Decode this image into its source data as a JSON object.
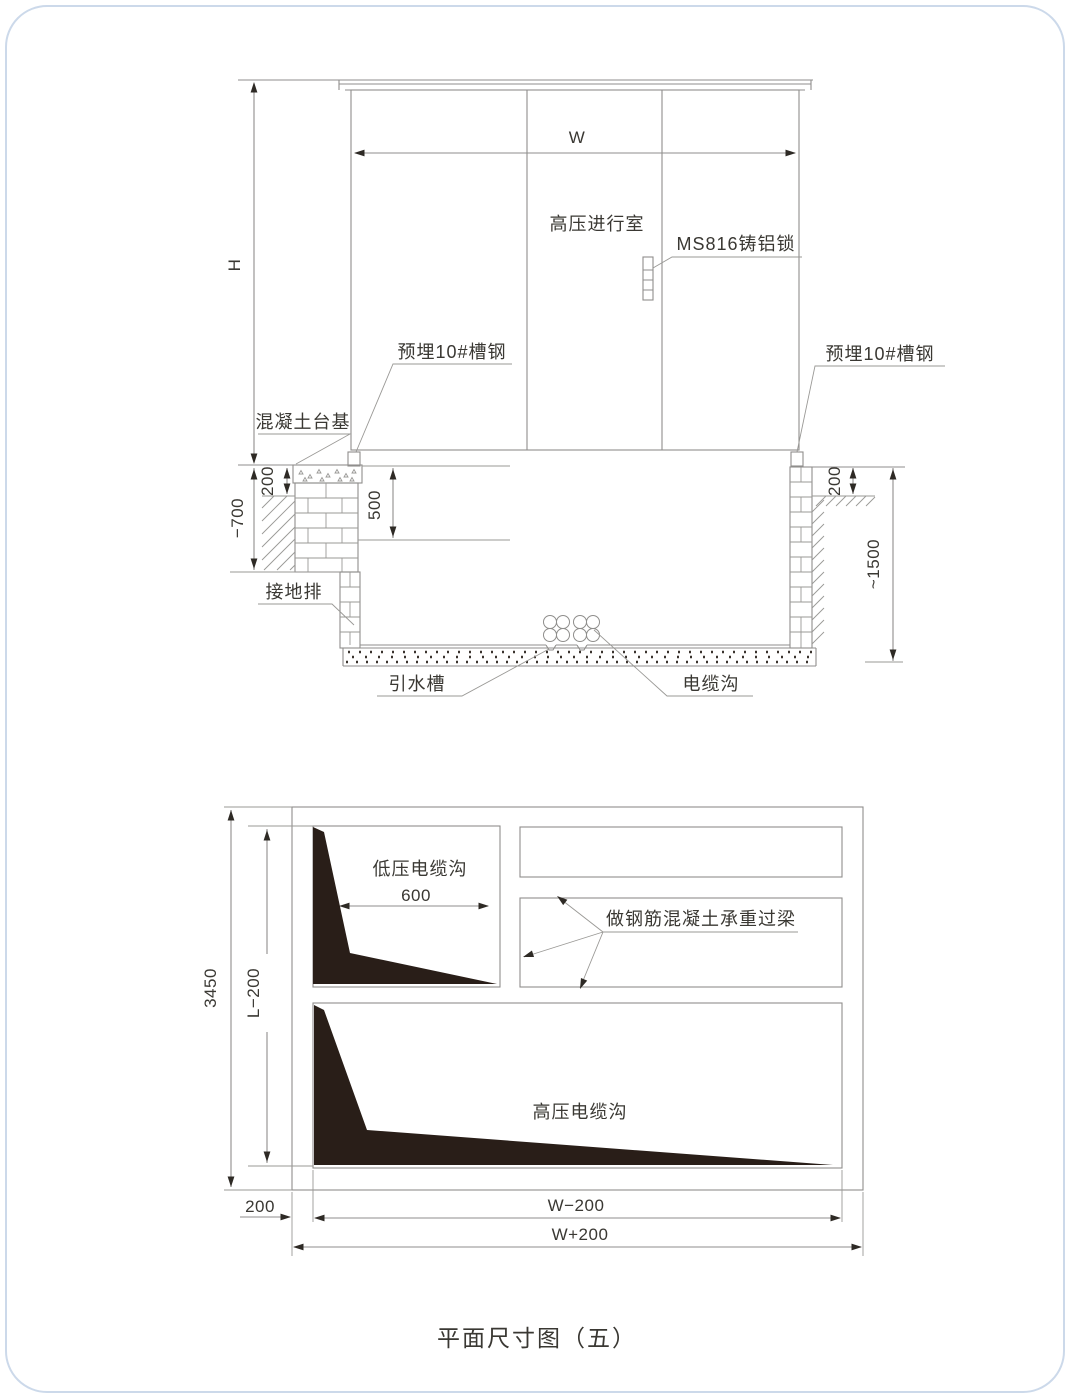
{
  "caption": "平面尺寸图（五）",
  "colors": {
    "card_border": "#ccd9ea",
    "line": "#8f8e8c",
    "text": "#3a3833",
    "solid_fill": "#291e18"
  },
  "elevation": {
    "labels": {
      "room": "高压进行室",
      "lock": "MS816铸铝锁",
      "embed_channel_left": "预埋10#槽钢",
      "embed_channel_right": "预埋10#槽钢",
      "concrete_base": "混凝土台基",
      "ground_bar": "接地排",
      "drain_channel": "引水槽",
      "cable_trench": "电缆沟"
    },
    "dims": {
      "width": "W",
      "height": "H",
      "pad_depth_left": "200",
      "ground_depth": "−700",
      "shelf_depth": "500",
      "pad_depth_right": "200",
      "pit_depth": "~1500"
    }
  },
  "plan": {
    "labels": {
      "lv_trench": "低压电缆沟",
      "lintel_note": "做钢筋混凝土承重过梁",
      "hv_trench": "高压电缆沟"
    },
    "dims": {
      "lv_width": "600",
      "overall_length": "3450",
      "inner_length": "L−200",
      "edge_offset": "200",
      "inner_width": "W−200",
      "outer_width": "W+200"
    }
  }
}
